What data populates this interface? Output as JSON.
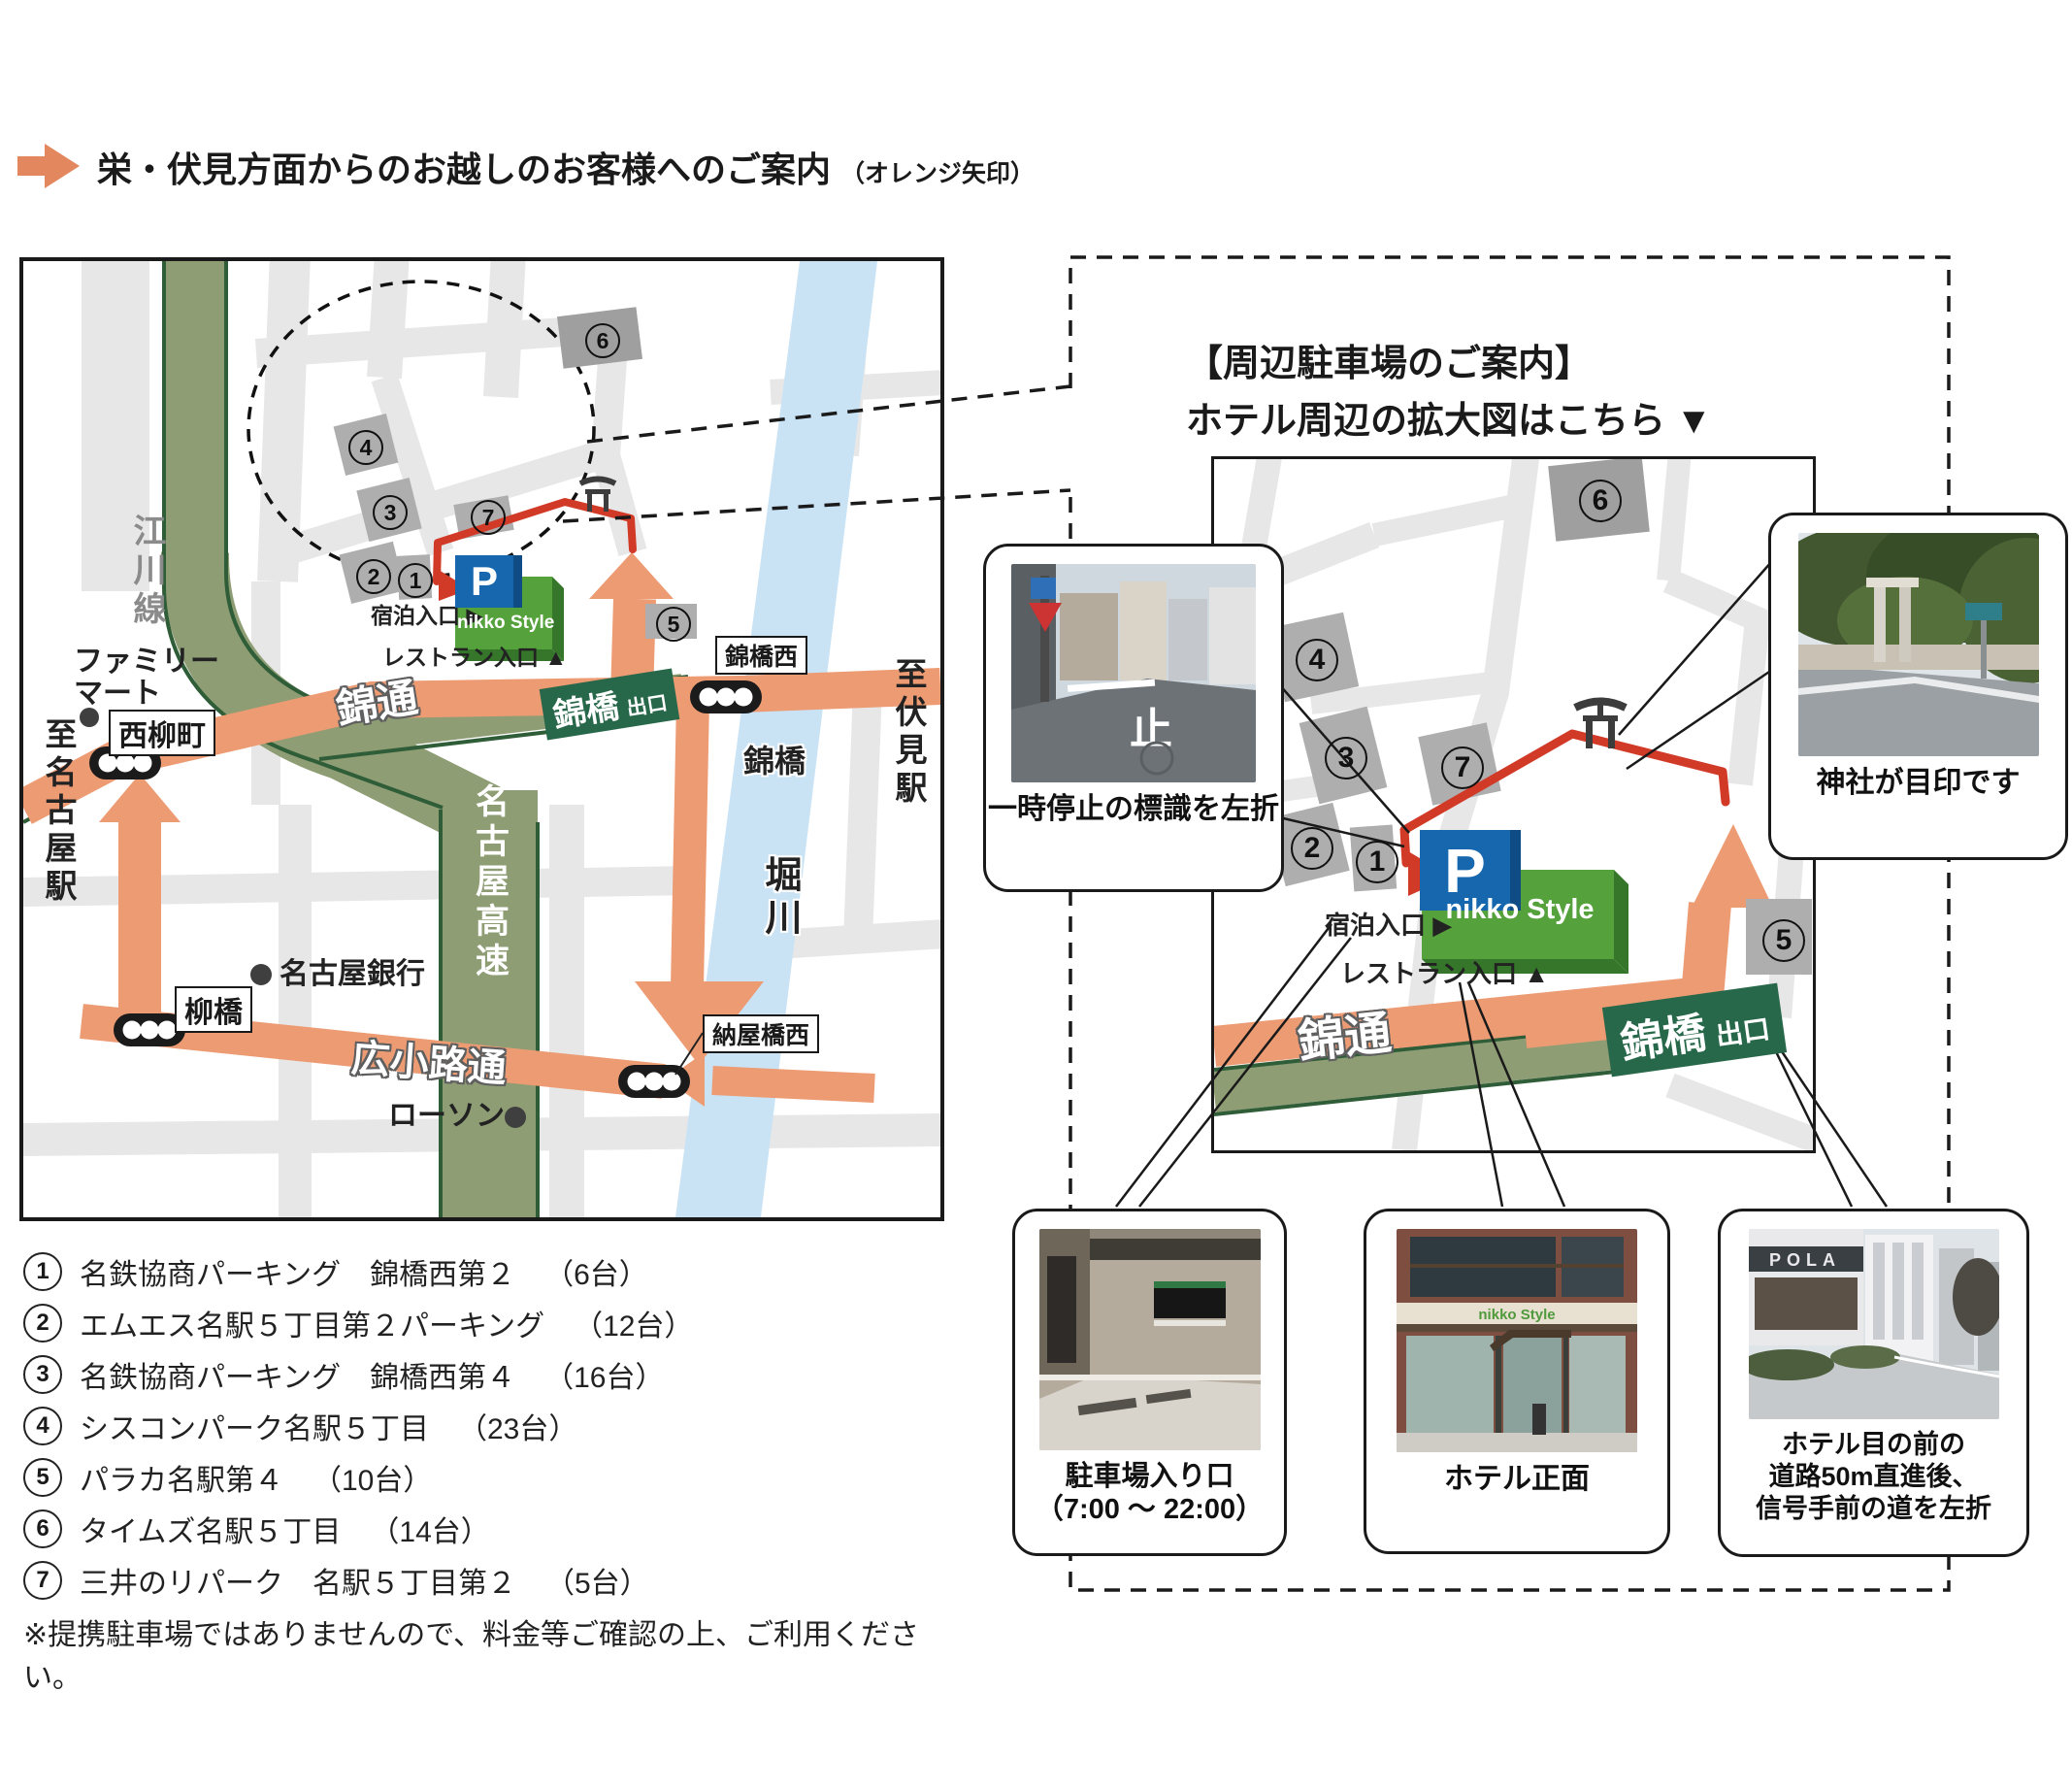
{
  "header": {
    "title": "栄・伏見方面からのお越しのお客様へのご案内",
    "suffix": "（オレンジ矢印）"
  },
  "right_panel": {
    "title_line1": "【周辺駐車場のご案内】",
    "title_line2": "ホテル周辺の拡大図はこちら ▼",
    "pola": "POLA"
  },
  "roads": {
    "egawa": "江川線",
    "expressway": "名古屋高速",
    "nishiki": "錦通",
    "hirokoji": "広小路通",
    "horikawa": "堀川",
    "bridge": "錦橋",
    "exit_main": "錦橋",
    "exit_sub": "出口",
    "to_nagoya": "至名古屋駅",
    "to_fushimi": "至伏見駅"
  },
  "signals": {
    "nishiyanagicho": "西柳町",
    "yanagibashi": "柳橋",
    "nishikibashi_nishi": "錦橋西",
    "nayabashi_nishi": "納屋橋西"
  },
  "pois": {
    "familymart1": "ファミリー",
    "familymart2": "マート",
    "bank": "名古屋銀行",
    "lawson": "ローソン"
  },
  "hotel": {
    "brand": "nikko Style",
    "p_mark": "P",
    "lodging_entrance": "宿泊入口 ▶",
    "restaurant_entrance": "レストラン入口 ▲"
  },
  "callouts": {
    "stop": "一時停止の標識を左折",
    "stop_marking": "止",
    "shrine": "神社が目印です",
    "parking1": "駐車場入り口",
    "parking2": "（7:00 ～ 22:00）",
    "hotel_front": "ホテル正面",
    "pola1": "ホテル目の前の",
    "pola2": "道路50m直進後、",
    "pola3": "信号手前の道を左折"
  },
  "parking_list": {
    "items": [
      {
        "num": "1",
        "name": "名鉄協商パーキング　錦橋西第２",
        "capacity": "（6台）"
      },
      {
        "num": "2",
        "name": "エムエス名駅５丁目第２パーキング",
        "capacity": "（12台）"
      },
      {
        "num": "3",
        "name": "名鉄協商パーキング　錦橋西第４",
        "capacity": "（16台）"
      },
      {
        "num": "4",
        "name": "シスコンパーク名駅５丁目",
        "capacity": "（23台）"
      },
      {
        "num": "5",
        "name": "パラカ名駅第４",
        "capacity": "（10台）"
      },
      {
        "num": "6",
        "name": "タイムズ名駅５丁目",
        "capacity": "（14台）"
      },
      {
        "num": "7",
        "name": "三井のリパーク　名駅５丁目第２",
        "capacity": "（5台）"
      }
    ],
    "note": "※提携駐車場ではありませんので、料金等ご確認の上、ご利用ください。"
  },
  "colors": {
    "route_orange": "#ED9B73",
    "route_red": "#D23A28",
    "expressway_olive": "#8E9D74",
    "expressway_edge": "#2F5D38",
    "exit_sign_green": "#28684A",
    "hotel_green": "#55A23C",
    "hotel_green_dark": "#35762A",
    "p_blue": "#1667AE",
    "river_blue": "#C9E3F5",
    "street_gray": "#E7E7E7",
    "block_gray": "#AEAEAE"
  }
}
